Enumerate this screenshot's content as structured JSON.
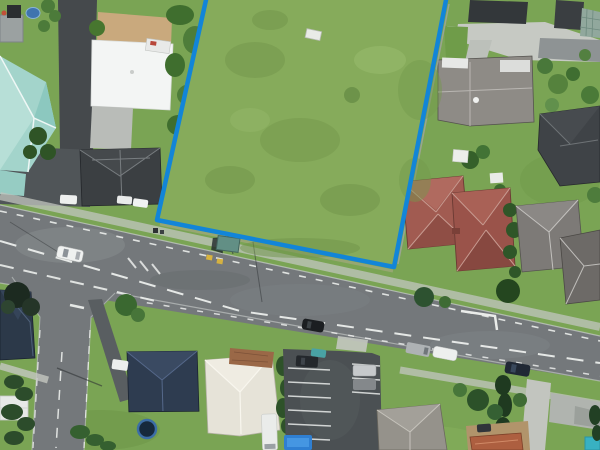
{
  "meta": {
    "view": "aerial-photo",
    "description": "Satellite view of a suburban block with a large vacant grass lot outlined by a blue property boundary, a main road running diagonally below it, a side street at lower left and houses with varied roof colors all around.",
    "canvas": {
      "width": 600,
      "height": 450
    }
  },
  "overlay": {
    "property_boundary": {
      "color": "#1285d8",
      "stroke_width": "4.5",
      "points_px": "206,0 157,220 394,267 446,0",
      "shape": "open polyline - lot continues past top edge of image",
      "encloses": "large vacant grass lot with one small white shed"
    }
  },
  "scene": {
    "lot": {
      "kind": "vacant grass lot",
      "fill": "#86ab5b",
      "shed_fill": "#e9ebe7"
    },
    "roads": [
      {
        "name": "main-road",
        "surface": "#74787b",
        "runs": "west-east, sloping down to the right",
        "markings": [
          "white dashed lane lines",
          "white edge tick dashes",
          "yellow bus-stop squares"
        ]
      },
      {
        "name": "side-street",
        "surface": "#74787b",
        "runs": "south from junction at lower left",
        "markings": [
          "white dashed edge lines",
          "white centre dashes"
        ]
      }
    ],
    "marking_colors": {
      "white": "#f2f4f2",
      "yellow": "#d9b43e"
    },
    "transit": {
      "bus_shelter": {
        "roof": "#628f85",
        "location": "verge below lot on main road"
      }
    },
    "vehicles": [
      {
        "name": "white-car-driving-west-section",
        "color": "#eff1f0"
      },
      {
        "name": "black-car-driving-centre",
        "color": "#1b1e21"
      },
      {
        "name": "navy-car-driving-east-section",
        "color": "#202835"
      },
      {
        "name": "grey-van-parked-south-kerb",
        "color": "#aeb2b4"
      },
      {
        "name": "white-car-parked-south-kerb",
        "color": "#edefee"
      },
      {
        "name": "white-car-at-charcoal-house-1",
        "color": "#e9ebea"
      },
      {
        "name": "white-car-at-charcoal-house-2",
        "color": "#f0f2f1"
      },
      {
        "name": "white-car-on-west-parking-area",
        "color": "#eef0ef"
      },
      {
        "name": "dark-car-in-parking-lot",
        "color": "#24282c"
      },
      {
        "name": "teal-car-in-parking-lot",
        "color": "#49a2a4"
      },
      {
        "name": "silver-car-in-parking-lot",
        "color": "#c6c9cb"
      },
      {
        "name": "grey-car-in-parking-lot",
        "color": "#84888b"
      },
      {
        "name": "white-van-bottom-centre",
        "color": "#eaecea"
      },
      {
        "name": "white-car-near-navy-house",
        "color": "#eceeed"
      },
      {
        "name": "dark-car-bottom-right",
        "color": "#30353a"
      }
    ],
    "buildings": [
      {
        "name": "teal-roof-house-northwest",
        "roof": "#a3d4cb"
      },
      {
        "name": "white-roof-building-northwest",
        "roof": "#f3f5f4"
      },
      {
        "name": "charcoal-hip-house-west",
        "roof": "#3b3f42"
      },
      {
        "name": "red-roof-house-a",
        "roof": "#a15b51"
      },
      {
        "name": "red-roof-house-b",
        "roof": "#9a534a"
      },
      {
        "name": "grey-hip-house-east",
        "roof": "#7d7a77"
      },
      {
        "name": "grey-hip-house-east-2",
        "roof": "#6d6a67"
      },
      {
        "name": "taupe-roof-house-northeast",
        "roof": "#8e8b86"
      },
      {
        "name": "charcoal-flat-roof-northeast",
        "roof": "#33373a"
      },
      {
        "name": "checkered-roof-northeast",
        "roof": "#91a89d"
      },
      {
        "name": "dark-hip-house-northeast",
        "roof": "#3f4347"
      },
      {
        "name": "navy-roof-house-southwest-1",
        "roof": "#2c3949"
      },
      {
        "name": "navy-roof-house-southwest-2",
        "roof": "#2e3c50"
      },
      {
        "name": "cream-hip-house-south",
        "roof": "#e6e3d8"
      },
      {
        "name": "grey-hip-house-southeast",
        "roof": "#95928b"
      },
      {
        "name": "terracotta-roof-southeast",
        "roof": "#ad5f40"
      },
      {
        "name": "white-shed-southwest",
        "roof": "#e7e9e7"
      }
    ],
    "features": {
      "parking_lot": {
        "surface": "#4b5053",
        "bays": "white striped"
      },
      "trampoline": {
        "mat": "#16293c",
        "rim": "#3c6ea6"
      },
      "blue_pool_cover": {
        "color": "#2f7fd2"
      },
      "teal_pool_corner": {
        "color": "#38b1c2"
      },
      "brown_deck": {
        "color": "#9a6847"
      },
      "tan_courtyard": {
        "color": "#c9a97d"
      },
      "dirt_yard": {
        "color": "#b1946b"
      },
      "blue_garden_pool_northwest": {
        "color": "#3f74ae"
      }
    }
  }
}
